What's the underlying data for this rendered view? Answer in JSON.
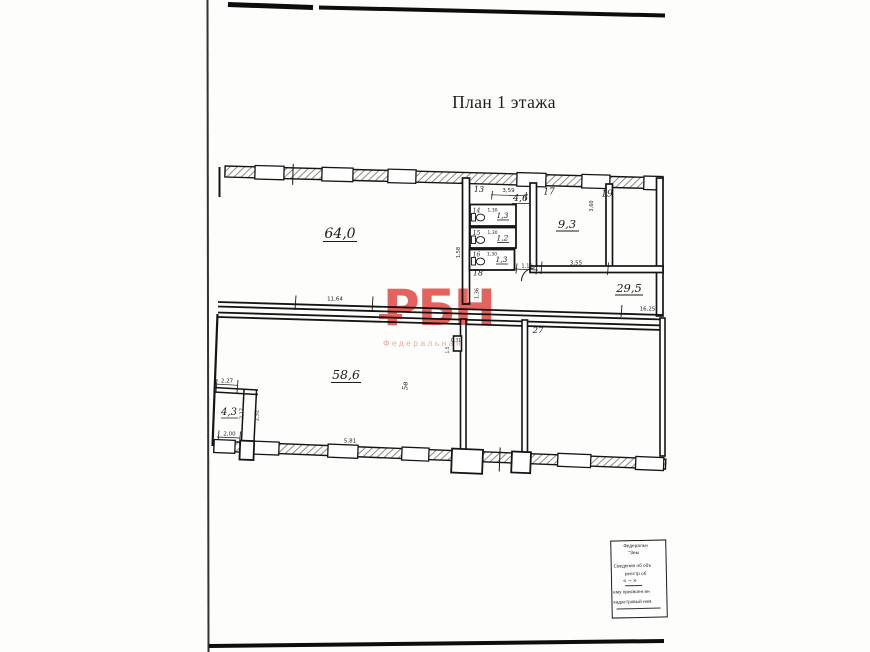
{
  "page": {
    "title": "План 1 этажа"
  },
  "watermark": {
    "logo": "РБН",
    "subtitle": "Федеральная"
  },
  "plan": {
    "areas": {
      "room64": "64,0",
      "room46": "4,6",
      "wc14": "1,3",
      "wc15": "1,2",
      "wc16": "1,3",
      "room93": "9,3",
      "room295": "29,5",
      "room586": "58,6",
      "room43": "4,3"
    },
    "numbers": {
      "n13": "13",
      "n14": "14",
      "n15": "15",
      "n16": "16",
      "n17": "17",
      "n18": "18",
      "n19": "19",
      "n27": "27",
      "mark5v": "5в"
    },
    "dims": {
      "d359": "3,59",
      "d130a": "1,30",
      "d130b": "1,30",
      "d130c": "1,30",
      "d158": "1,58",
      "d110": "1,10",
      "d355": "3,55",
      "d360": "3,60",
      "d1164": "11,64",
      "d136": "1,36",
      "d1625": "16,25",
      "d031": "0,31",
      "d15": "1,5",
      "d227": "2,27",
      "d217": "2,17",
      "d252": "2,52",
      "d200": "2,00",
      "d581": "5,81"
    }
  },
  "stamp": {
    "lines": [
      "Федеральн",
      "\"Зем",
      "Сведения об объ",
      "реестр об",
      "« ~ »",
      "ему присвоен ин",
      "кадастровый ном"
    ]
  }
}
